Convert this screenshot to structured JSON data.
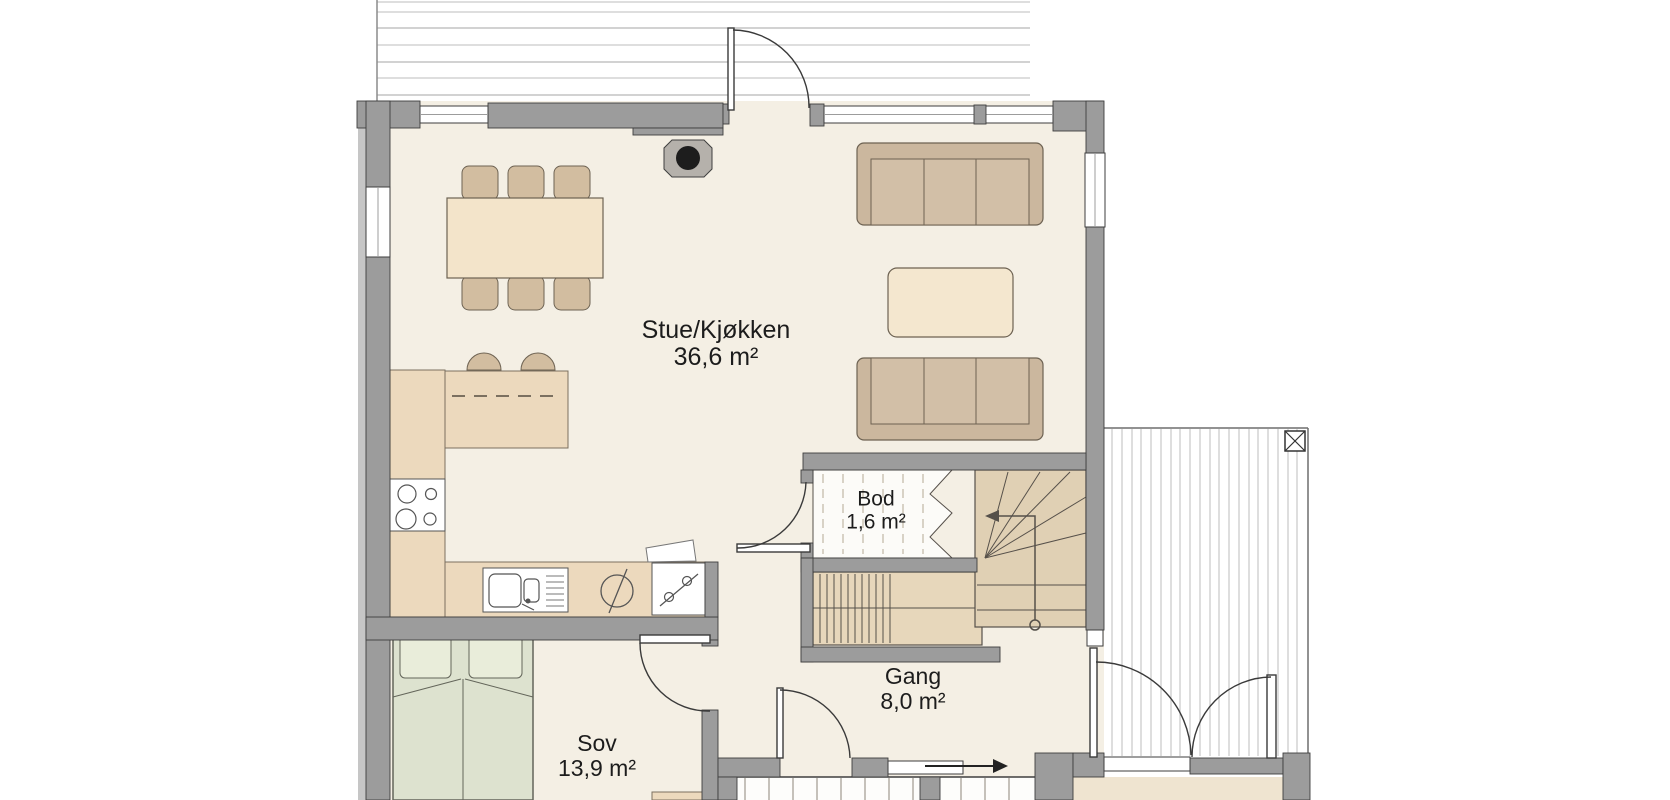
{
  "plan": {
    "kind": "architectural floor plan",
    "rooms": [
      {
        "id": "stue-kjokken",
        "name": "Stue/Kjøkken",
        "area": "36,6 m²"
      },
      {
        "id": "bod",
        "name": "Bod",
        "area": "1,6 m²"
      },
      {
        "id": "gang",
        "name": "Gang",
        "area": "8,0 m²"
      },
      {
        "id": "sov",
        "name": "Sov",
        "area": "13,9 m²"
      }
    ],
    "symbols": [
      "dining-table-with-six-chairs",
      "kitchen-island-with-two-stools",
      "cooktop-four-burners",
      "double-sink-with-drainboard",
      "dishwasher-circle-symbol",
      "stove-symbol",
      "wood-stove",
      "two-sofas-with-coffee-table",
      "double-bed",
      "winder-staircase-with-direction-arrow",
      "storage-under-stairs-dashed",
      "deck-planks-top",
      "deck-planks-right",
      "deck-post-x-marker",
      "entry-direction-arrow",
      "door-swing-arcs",
      "tiled-bathroom-floor"
    ],
    "colors": {
      "wall_gray": "#9c9c9c",
      "wall_edge": "#3e3e3e",
      "floor_cream": "#f4efe4",
      "counter_tan": "#ecd9bd",
      "sofa_tan": "#cbb79e",
      "table_cream": "#f3e4ca",
      "bed_green": "#dde2cf",
      "pillow_green": "#e9edda",
      "stair_tan": "#e7d7bb",
      "winder_tan": "#e0d0b4",
      "deck_line_gray": "#bcbcbc",
      "bod_floor_white": "#fcfbf8",
      "text_black": "#1c1c1c"
    }
  }
}
